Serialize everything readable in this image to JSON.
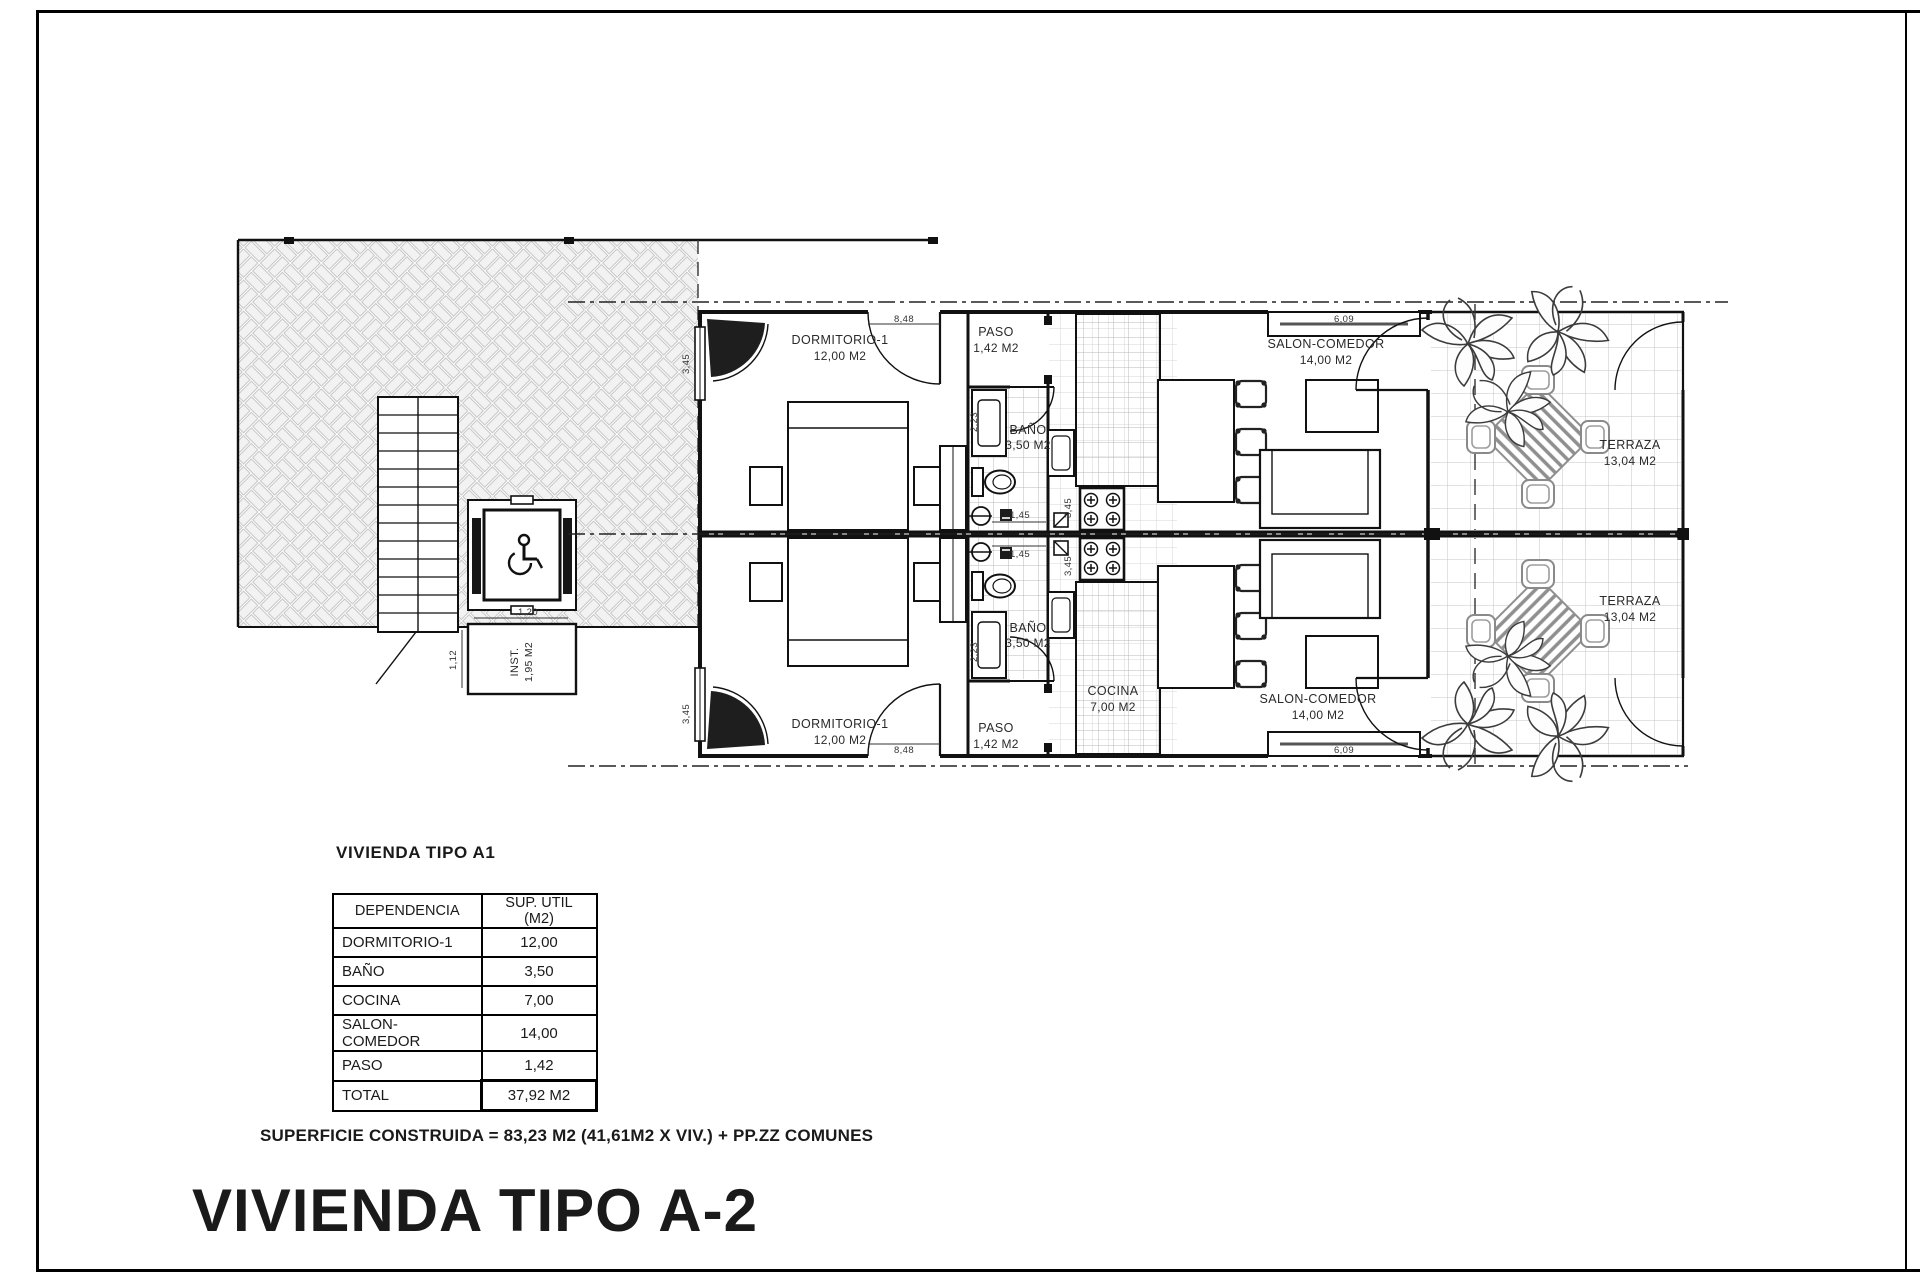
{
  "sheet": {
    "title": "VIVIENDA TIPO A-2",
    "construction_note": "SUPERFICIE CONSTRUIDA = 83,23 M2 (41,61M2 X VIV.) + PP.ZZ COMUNES"
  },
  "plan": {
    "rooms": {
      "dormitorio": {
        "name": "DORMITORIO-1",
        "area": "12,00 M2"
      },
      "paso": {
        "name": "PASO",
        "area": "1,42 M2"
      },
      "bano": {
        "name": "BAÑO",
        "area": "3,50 M2"
      },
      "cocina": {
        "name": "COCINA",
        "area": "7,00 M2"
      },
      "salon": {
        "name": "SALON-COMEDOR",
        "area": "14,00 M2"
      },
      "terraza": {
        "name": "TERRAZA",
        "area": "13,04 M2"
      },
      "inst": {
        "name": "INST.",
        "area": "1,95 M2"
      }
    },
    "dimensions": {
      "dorm_width": "8,48",
      "dorm_window": "3,45",
      "salon_window": "6,09",
      "bano_width": "1,45",
      "cocina_depth": "3,45",
      "vanity_depth": "2,23",
      "stair_width": "1,12",
      "elevator_width": "1,20"
    }
  },
  "area_table": {
    "heading": "VIVIENDA TIPO A1",
    "columns": [
      "DEPENDENCIA",
      "SUP. UTIL (M2)"
    ],
    "rows": [
      [
        "DORMITORIO-1",
        "12,00"
      ],
      [
        "BAÑO",
        "3,50"
      ],
      [
        "COCINA",
        "7,00"
      ],
      [
        "SALON-COMEDOR",
        "14,00"
      ],
      [
        "PASO",
        "1,42"
      ]
    ],
    "total_label": "TOTAL",
    "total_value": "37,92 M2"
  }
}
